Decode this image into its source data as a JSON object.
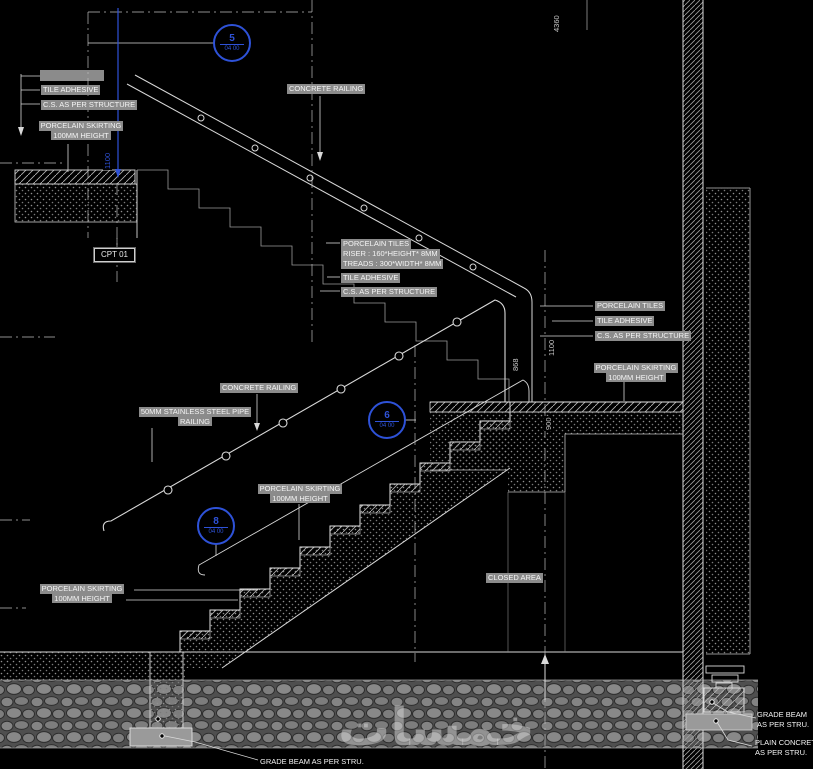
{
  "drawing": {
    "labels": {
      "tile_adhesive": "TILE ADHESIVE",
      "cs_structure": "C.S. AS PER STRUCTURE",
      "skirting_l1": "PORCELAIN SKIRTING",
      "skirting_l2": "100MM HEIGHT",
      "porcelain_tiles": "PORCELAIN TILES",
      "riser_spec": "RISER : 160*HEIGHT* 8MM",
      "treads_spec": "TREADS : 300*WIDTH* 8MM",
      "concrete_railing": "CONCRETE RAILING",
      "pipe_railing_l1": "50MM STAINLESS STEEL PIPE",
      "pipe_railing_l2": "RAILING",
      "closed_area": "CLOSED AREA",
      "cpt_tag": "CPT 01",
      "grade_beam_l1": "GRADE BEAM",
      "grade_beam_l2": "AS PER STRU.",
      "plain_concrete_l1": "PLAIN CONCRETE",
      "plain_concrete_l2": "AS PER STRU.",
      "grade_beam_bottom": "GRADE BEAM AS PER STRU."
    },
    "dimensions": {
      "overall_height": "4360",
      "left_rail_height": "1100",
      "rail_height": "868",
      "mid_height": "1100",
      "landing_depth": "900"
    },
    "callouts": [
      {
        "number": "5",
        "sheet": "04 00"
      },
      {
        "number": "6",
        "sheet": "04 00"
      },
      {
        "number": "8",
        "sheet": "04 00"
      }
    ],
    "watermark": "خمسات",
    "colors": {
      "background": "#000000",
      "linework": "#d9d9d9",
      "fill_gray": "#8b8b8b",
      "accent_blue": "#2e52d8"
    }
  }
}
